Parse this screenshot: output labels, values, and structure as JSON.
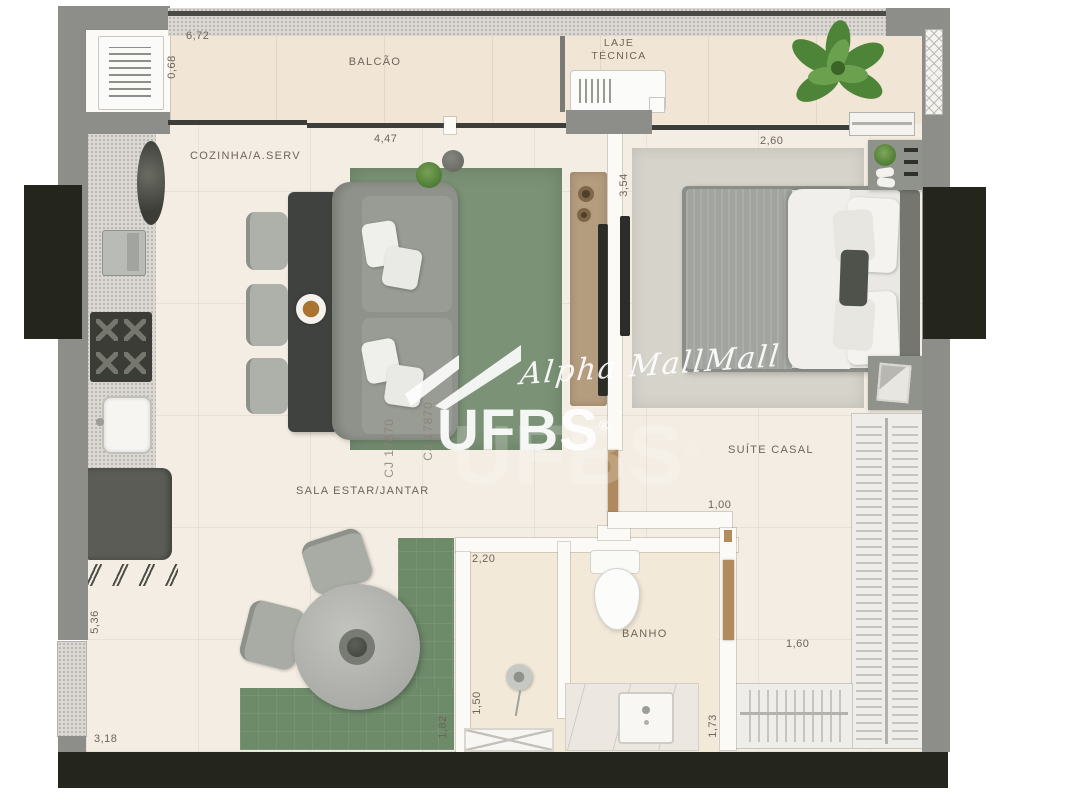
{
  "watermark": {
    "brand": "UFBS",
    "registered": "®",
    "signature": "Alpha MallMall",
    "license_code": "CJ 17870"
  },
  "rooms": {
    "balcony": "BALCÃO",
    "technical_slab_line1": "LAJE",
    "technical_slab_line2": "TÉCNICA",
    "kitchen_service": "COZINHA/A.SERV",
    "living_dining": "SALA ESTAR/JANTAR",
    "master_suite": "SUÍTE CASAL",
    "bathroom": "BANHO"
  },
  "dimensions_m": {
    "balcony_width": "6,72",
    "balcony_depth": "0,68",
    "living_width": "4,47",
    "suite_width": "2,60",
    "suite_depth": "3,54",
    "kitchen_wall": "5,36",
    "bottom_wall": "3,18",
    "shower_width": "2,20",
    "suite_door": "1,00",
    "shower_depth": "1,50",
    "dining_rug": "1,82",
    "closet_width": "1,60",
    "bath_side": "1,73"
  }
}
